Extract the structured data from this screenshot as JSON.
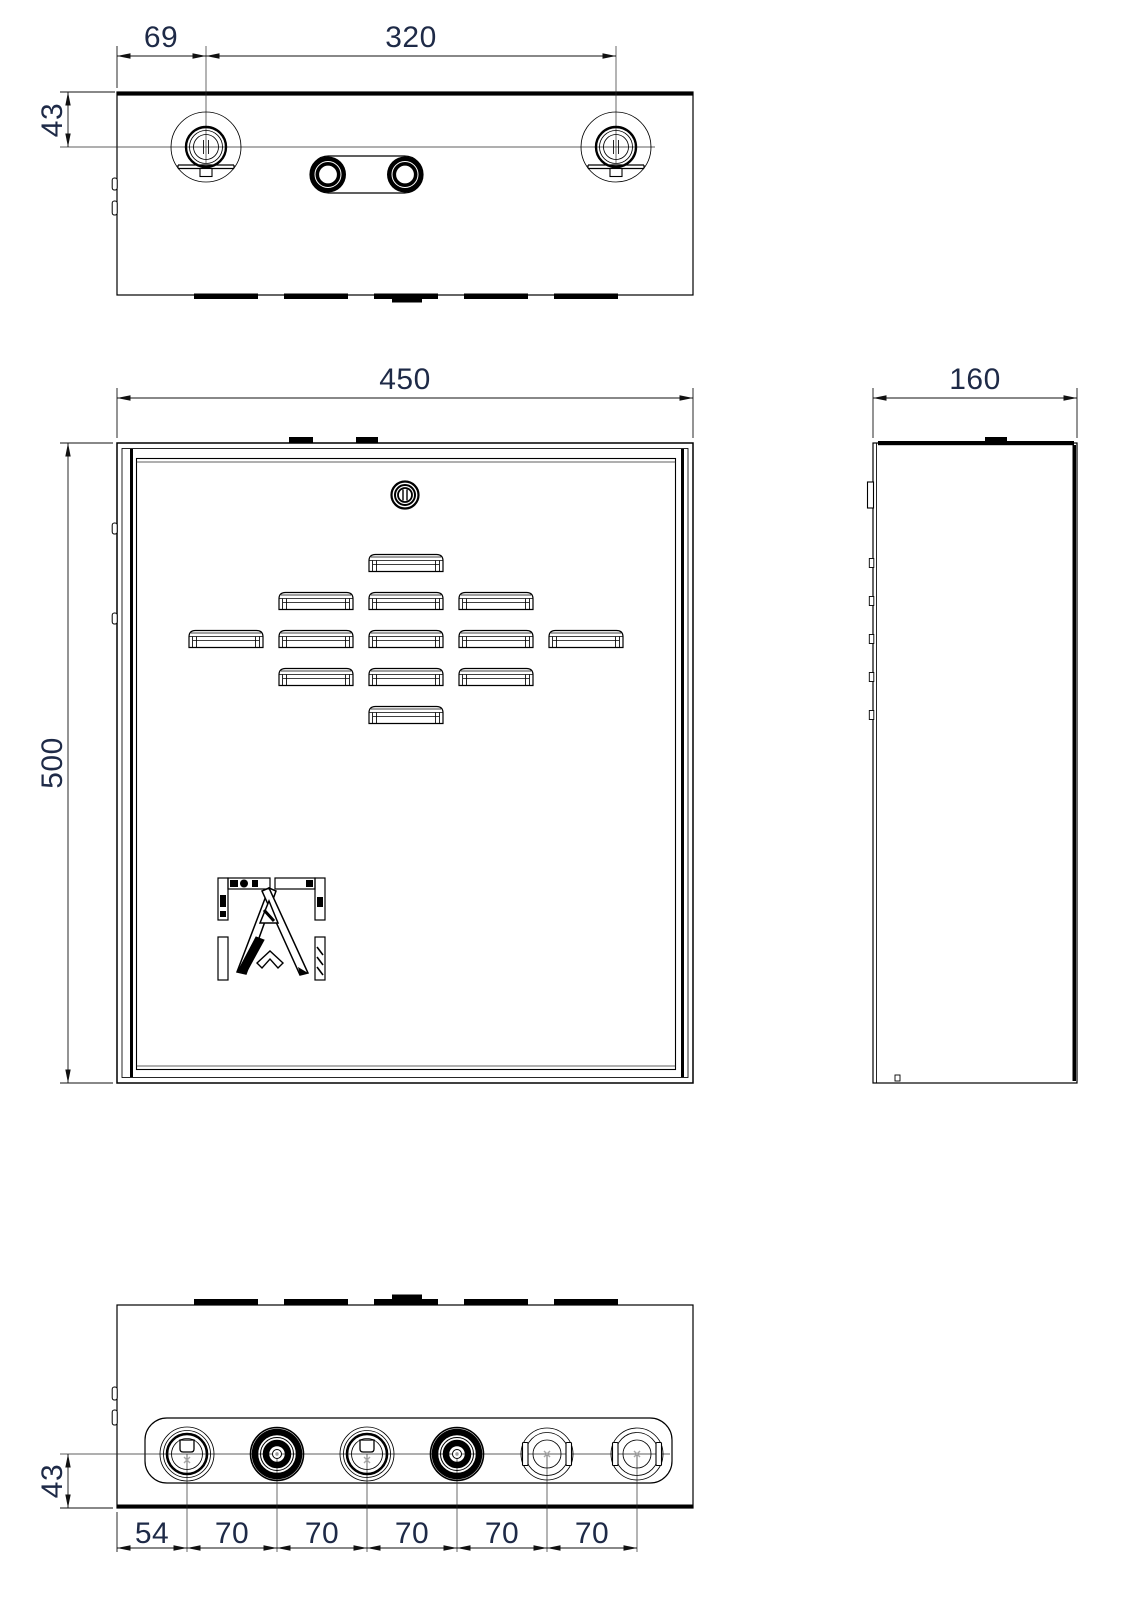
{
  "drawing": {
    "kind": "enclosure-orthographic-views",
    "colors": {
      "line": "#000000",
      "dimension_text": "#1e2a47",
      "background": "#ffffff"
    },
    "dimension_labels": {
      "top_view": {
        "hole_offset": "69",
        "hole_spacing": "320",
        "hole_depth": "43"
      },
      "front_view": {
        "width": "450",
        "height": "500"
      },
      "side_view": {
        "depth": "160"
      },
      "bottom_view": {
        "gland_height": "43",
        "segments": [
          "54",
          "70",
          "70",
          "70",
          "70",
          "70"
        ]
      }
    }
  }
}
